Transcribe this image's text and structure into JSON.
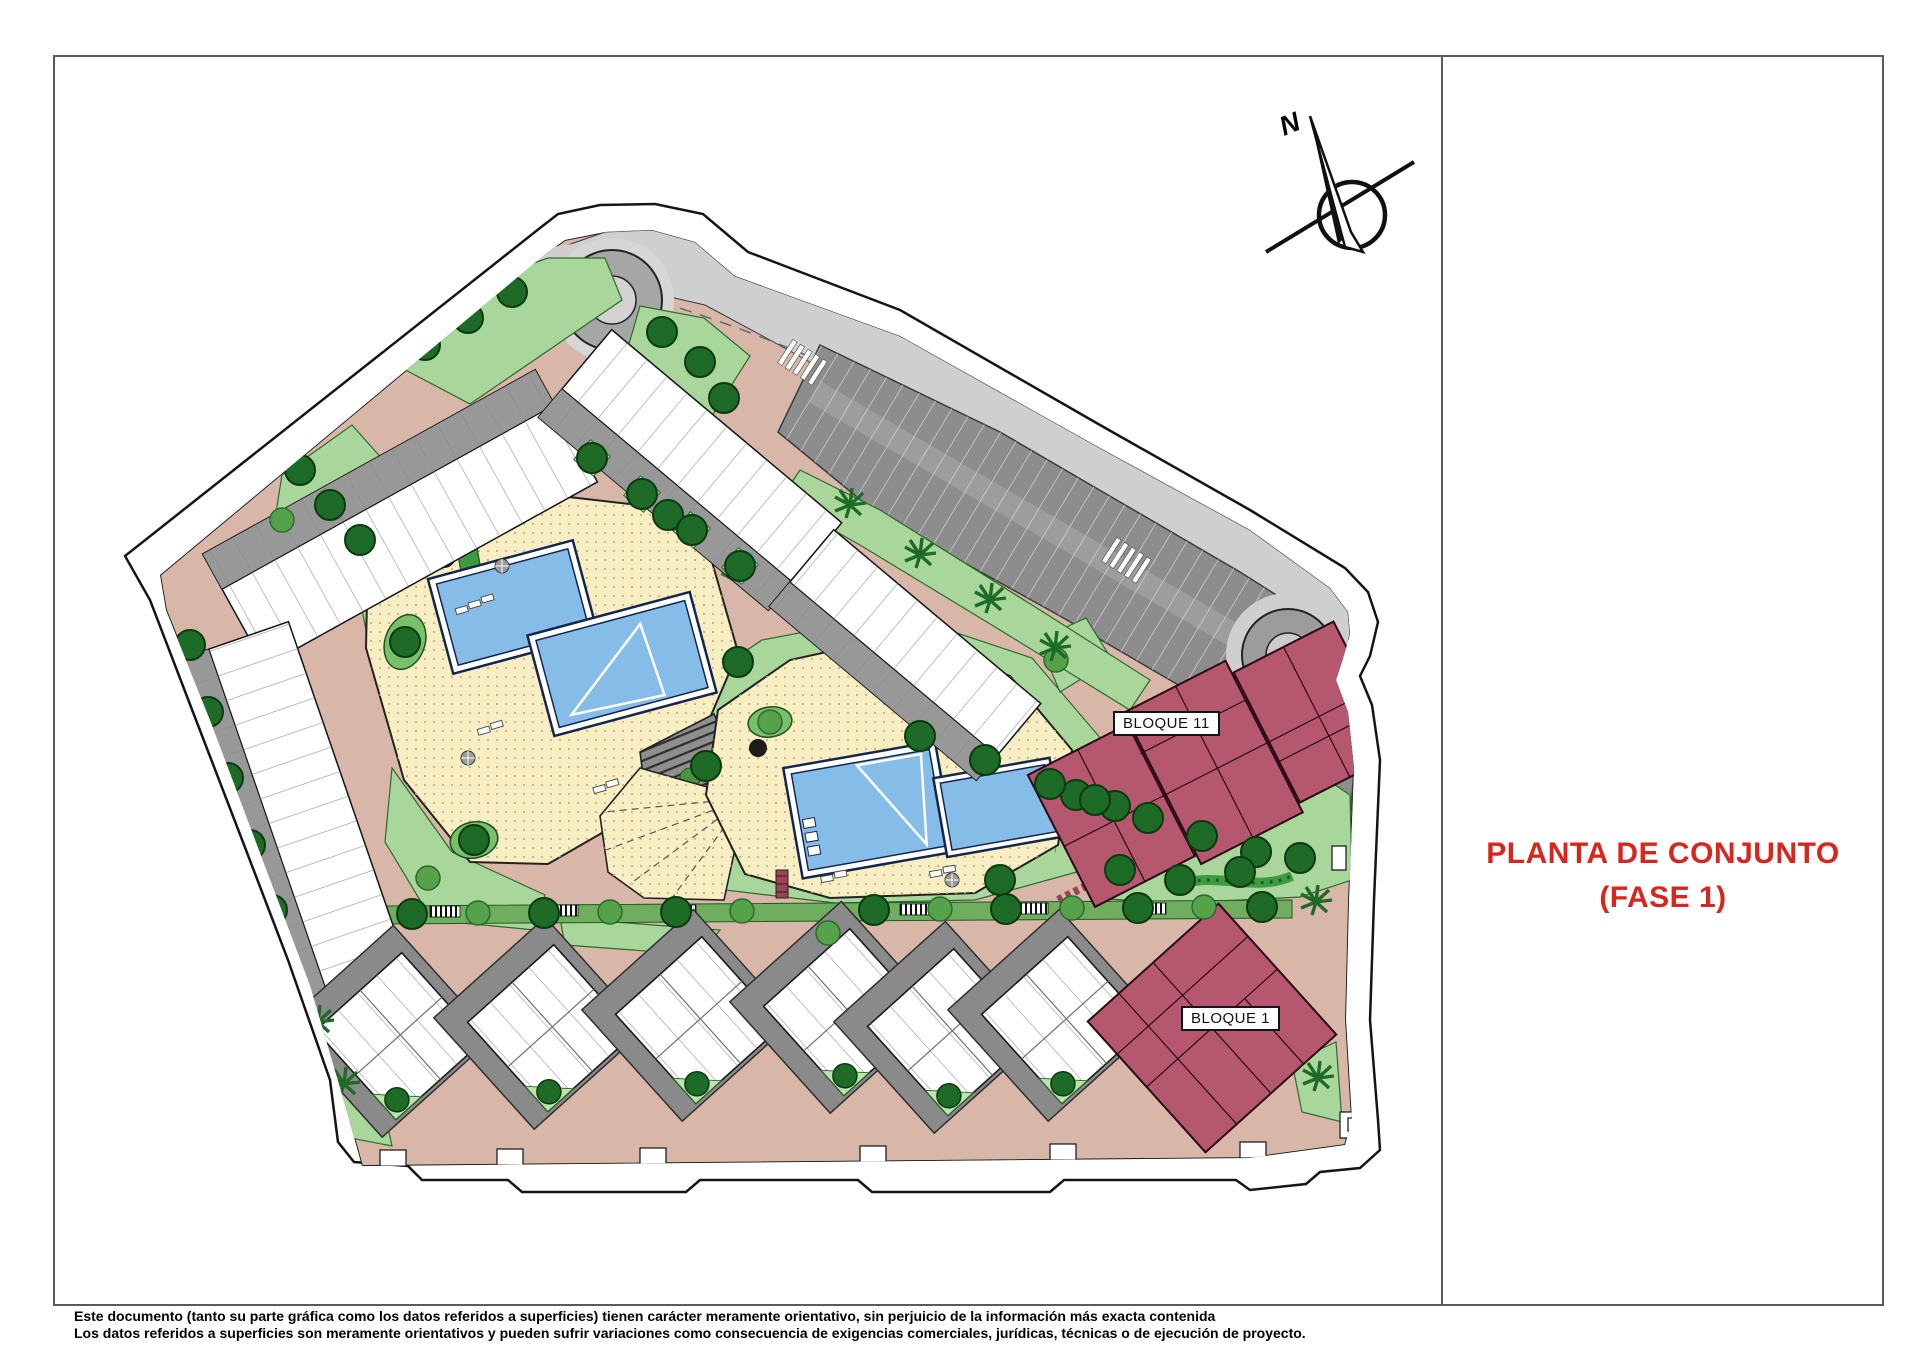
{
  "sheet": {
    "title": {
      "line1": "PLANTA DE CONJUNTO",
      "line2": "(FASE 1)"
    },
    "disclaimer": {
      "line1": "Este documento (tanto su parte gráfica como los datos referidos a superficies) tienen carácter meramente orientativo, sin perjuicio de la información más exacta contenida",
      "line2": "Los datos referidos a superficies son meramente orientativos y pueden sufrir variaciones como consecuencia de exigencias comerciales, jurídicas, técnicas o de ejecución de proyecto."
    }
  },
  "plan": {
    "north_label": "N",
    "blocks": {
      "bloque11": "BLOQUE 11",
      "bloque1": "BLOQUE 1"
    }
  },
  "colors": {
    "title_red": "#d9251c",
    "building_maroon": "#b5576e",
    "green": "#a9d79b",
    "path_tan": "#d8b6a8",
    "deck_yellow": "#f7eec4",
    "pool_blue": "#85bce8",
    "road_light": "#cfcfcf",
    "parking_gray": "#8d8d8d"
  }
}
